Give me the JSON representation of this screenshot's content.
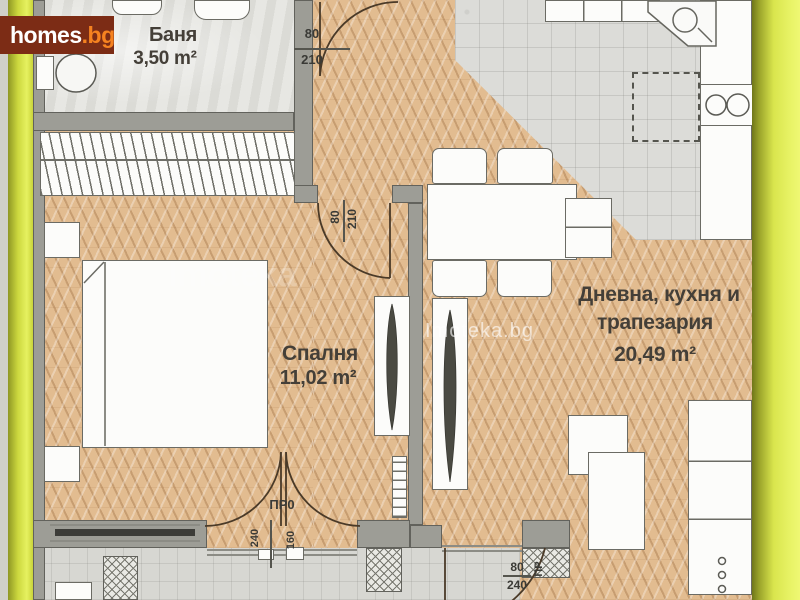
{
  "branding": {
    "logo": {
      "text_main": "homes",
      "text_suffix": ".bg"
    },
    "watermark_center": "Imoteka.bg",
    "watermark_faint": "Imoteka"
  },
  "rooms": {
    "bathroom": {
      "label": "Баня",
      "area": "3,50 m²"
    },
    "bedroom": {
      "label": "Спалня",
      "area": "11,02 m²"
    },
    "living": {
      "label_line1": "Дневна, кухня и",
      "label_line2": "трапезария",
      "area": "20,49 m²"
    }
  },
  "door_labels": {
    "bathroom_door": {
      "width": "80",
      "height": "210"
    },
    "bedroom_door": {
      "width": "80",
      "height": "210"
    },
    "balcony_door": {
      "tag": "ПР0",
      "height": "240",
      "width": "160"
    },
    "terrace_door": {
      "width": "80",
      "height": "240",
      "tag": "ПР"
    }
  },
  "colors": {
    "frame-yellow": "#d9e54d",
    "frame-olive": "#8f9724",
    "logo-bg": "#7c2c15",
    "logo-main": "#ffffff",
    "logo-accent": "#f58220",
    "wood-floor": "#e2bc90",
    "tile-floor": "#dcdcd8",
    "wall": "#9d9d96",
    "line": "#4a3a28",
    "label-text": "#443f38"
  }
}
